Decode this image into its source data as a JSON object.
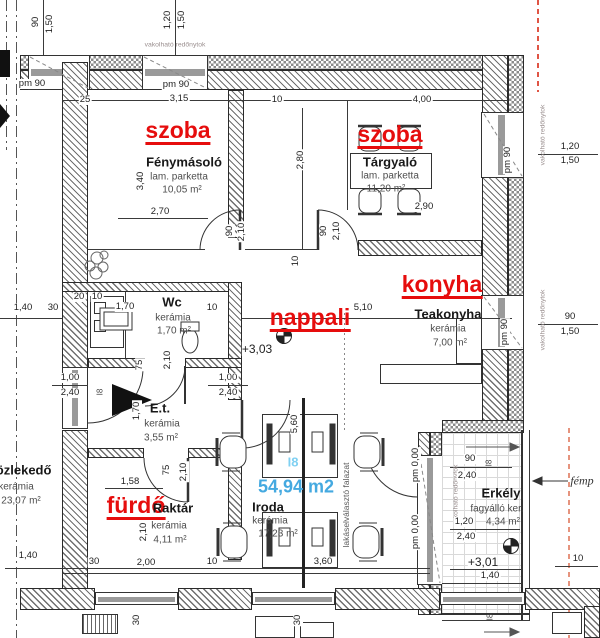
{
  "canvas": {
    "width": 600,
    "height": 638,
    "background": "#ffffff"
  },
  "colors": {
    "red_label": "#e60d0d",
    "blue_label_big": "#44a9e0",
    "blue_label_small": "#7fd0f2",
    "wall_line": "#2a2a2a",
    "dim_text": "#222222",
    "red_dash_line": "#e05545",
    "orange_dash_line": "#e6947e"
  },
  "rooms": [
    {
      "overlay": "szoba",
      "name": "Fénymásoló",
      "flooring": "lam. parketta",
      "area": "10,05 m²"
    },
    {
      "overlay": "szoba",
      "name": "Tárgyaló",
      "flooring": "lam. parketta",
      "area": "11,20 m²"
    },
    {
      "overlay": "konyha",
      "name": "Teakonyha",
      "flooring": "kerámia",
      "area": "7,00 m²"
    },
    {
      "overlay": "nappali",
      "name": "Iroda",
      "flooring": "kerámia",
      "area": "17,23 m²"
    },
    {
      "overlay": "",
      "name": "Wc",
      "flooring": "kerámia",
      "area": "1,70 m²"
    },
    {
      "overlay": "",
      "name": "E.t.",
      "flooring": "kerámia",
      "area": "3,55 m²"
    },
    {
      "overlay": "",
      "name": "közlekedő",
      "flooring": "kerámia",
      "area": "23,07 m²"
    },
    {
      "overlay": "fürdő",
      "name": "Raktár",
      "flooring": "kerámia",
      "area": "4,11 m²"
    },
    {
      "overlay": "",
      "name": "Erkély",
      "flooring": "fagyálló ker.",
      "area": "4,34 m²"
    }
  ],
  "unit": {
    "id": "I8",
    "total_area": "54,94 m2",
    "levels": [
      "+3,03",
      "+3,01"
    ]
  },
  "labels": [
    {
      "n": "dim-90-tl",
      "t": "90",
      "x": 36,
      "y": 22,
      "r": -90,
      "c": "dim"
    },
    {
      "n": "dim-150-tl",
      "t": "1,50",
      "x": 50,
      "y": 24,
      "r": -90,
      "c": "dim"
    },
    {
      "n": "dim-120-tl2",
      "t": "1,20",
      "x": 168,
      "y": 20,
      "r": -90,
      "c": "dim"
    },
    {
      "n": "dim-150-tl2",
      "t": "1,50",
      "x": 182,
      "y": 20,
      "r": -90,
      "c": "dim"
    },
    {
      "n": "redony-top",
      "t": "vakolható redőnytok",
      "x": 175,
      "y": 45,
      "r": 0,
      "c": "tiny"
    },
    {
      "n": "pm90-top-a",
      "t": "pm 90",
      "x": 32,
      "y": 84,
      "r": 0,
      "c": "dim"
    },
    {
      "n": "pm90-top-b",
      "t": "pm 90",
      "x": 176,
      "y": 85,
      "r": 0,
      "c": "dim"
    },
    {
      "n": "dim-25",
      "t": "25",
      "x": 85,
      "y": 100,
      "r": 0,
      "c": "dim"
    },
    {
      "n": "dim-315",
      "t": "3,15",
      "x": 179,
      "y": 99,
      "r": 0,
      "c": "dim"
    },
    {
      "n": "dim-10-top",
      "t": "10",
      "x": 277,
      "y": 100,
      "r": 0,
      "c": "dim"
    },
    {
      "n": "dim-400",
      "t": "4,00",
      "x": 422,
      "y": 100,
      "r": 0,
      "c": "dim"
    },
    {
      "n": "red-szoba-1",
      "t": "szoba",
      "x": 178,
      "y": 132,
      "r": 0,
      "c": "red"
    },
    {
      "n": "title-fenymasolo",
      "t": "Fénymásoló",
      "x": 184,
      "y": 162,
      "r": 0,
      "c": "rt"
    },
    {
      "n": "sub-lam-1",
      "t": "lam. parketta",
      "x": 179,
      "y": 177,
      "r": 0,
      "c": "sub"
    },
    {
      "n": "sub-area-1",
      "t": "10,05 m²",
      "x": 182,
      "y": 190,
      "r": 0,
      "c": "sub"
    },
    {
      "n": "dim-340",
      "t": "3,40",
      "x": 141,
      "y": 181,
      "r": -90,
      "c": "dim"
    },
    {
      "n": "dim-270",
      "t": "2,70",
      "x": 160,
      "y": 212,
      "r": 0,
      "c": "dim"
    },
    {
      "n": "red-szoba-2",
      "t": "szoba",
      "x": 390,
      "y": 136,
      "r": 0,
      "c": "red"
    },
    {
      "n": "title-targyalo",
      "t": "Tárgyaló",
      "x": 390,
      "y": 162,
      "r": 0,
      "c": "rt"
    },
    {
      "n": "sub-lam-2",
      "t": "lam. parketta",
      "x": 390,
      "y": 176,
      "r": 0,
      "c": "sub"
    },
    {
      "n": "sub-area-2",
      "t": "11,20 m²",
      "x": 386,
      "y": 189,
      "r": 0,
      "c": "sub"
    },
    {
      "n": "dim-290",
      "t": "2,90",
      "x": 424,
      "y": 207,
      "r": 0,
      "c": "dim"
    },
    {
      "n": "dim-280",
      "t": "2,80",
      "x": 301,
      "y": 160,
      "r": -90,
      "c": "dim"
    },
    {
      "n": "pm90-right-top",
      "t": "pm 90",
      "x": 508,
      "y": 160,
      "r": -90,
      "c": "dim"
    },
    {
      "n": "dim-120-rt",
      "t": "1,20",
      "x": 570,
      "y": 147,
      "r": 0,
      "c": "dim"
    },
    {
      "n": "dim-150-rt",
      "t": "1,50",
      "x": 570,
      "y": 161,
      "r": 0,
      "c": "dim"
    },
    {
      "n": "redony-right-top",
      "t": "vakolható redőnytok",
      "x": 543,
      "y": 135,
      "r": -90,
      "c": "tiny"
    },
    {
      "n": "dim-90-door-l",
      "t": "90",
      "x": 230,
      "y": 231,
      "r": -90,
      "c": "dim"
    },
    {
      "n": "dim-210-door-l",
      "t": "2,10",
      "x": 242,
      "y": 232,
      "r": -90,
      "c": "dim"
    },
    {
      "n": "dim-90-door-r",
      "t": "90",
      "x": 324,
      "y": 231,
      "r": -90,
      "c": "dim"
    },
    {
      "n": "dim-210-door-r",
      "t": "2,10",
      "x": 337,
      "y": 231,
      "r": -90,
      "c": "dim"
    },
    {
      "n": "dim-10-mid",
      "t": "10",
      "x": 296,
      "y": 261,
      "r": -90,
      "c": "dim"
    },
    {
      "n": "red-konyha",
      "t": "konyha",
      "x": 442,
      "y": 286,
      "r": 0,
      "c": "red"
    },
    {
      "n": "title-teakonyha",
      "t": "Teakonyha",
      "x": 448,
      "y": 314,
      "r": 0,
      "c": "rt"
    },
    {
      "n": "sub-ker-teak",
      "t": "kerámia",
      "x": 448,
      "y": 329,
      "r": 0,
      "c": "sub"
    },
    {
      "n": "sub-area-teak",
      "t": "7,00 m²",
      "x": 450,
      "y": 343,
      "r": 0,
      "c": "sub"
    },
    {
      "n": "dim-510",
      "t": "5,10",
      "x": 363,
      "y": 308,
      "r": 0,
      "c": "dim"
    },
    {
      "n": "pm90-right-mid",
      "t": "pm 90",
      "x": 505,
      "y": 332,
      "r": -90,
      "c": "dim"
    },
    {
      "n": "dim-90-r",
      "t": "90",
      "x": 570,
      "y": 317,
      "r": 0,
      "c": "dim"
    },
    {
      "n": "dim-150-r",
      "t": "1,50",
      "x": 570,
      "y": 332,
      "r": 0,
      "c": "dim"
    },
    {
      "n": "redony-right-mid",
      "t": "vakolható redőnytok",
      "x": 543,
      "y": 320,
      "r": -90,
      "c": "tiny"
    },
    {
      "n": "red-nappali",
      "t": "nappali",
      "x": 310,
      "y": 319,
      "r": 0,
      "c": "red"
    },
    {
      "n": "lvl-303",
      "t": "+3,03",
      "x": 257,
      "y": 349,
      "r": 0,
      "c": "lvl"
    },
    {
      "n": "dim-20",
      "t": "20",
      "x": 79,
      "y": 297,
      "r": 0,
      "c": "dim"
    },
    {
      "n": "dim-10-wc-l",
      "t": "10",
      "x": 97,
      "y": 297,
      "r": 0,
      "c": "dim"
    },
    {
      "n": "title-wc",
      "t": "Wc",
      "x": 172,
      "y": 302,
      "r": 0,
      "c": "rt"
    },
    {
      "n": "sub-ker-wc",
      "t": "kerámia",
      "x": 173,
      "y": 318,
      "r": 0,
      "c": "sub"
    },
    {
      "n": "sub-area-wc",
      "t": "1,70 m²",
      "x": 174,
      "y": 331,
      "r": 0,
      "c": "sub"
    },
    {
      "n": "dim-170",
      "t": "1,70",
      "x": 125,
      "y": 307,
      "r": 0,
      "c": "dim"
    },
    {
      "n": "dim-10-wc-r",
      "t": "10",
      "x": 212,
      "y": 308,
      "r": 0,
      "c": "dim"
    },
    {
      "n": "dim-140-l",
      "t": "1,40",
      "x": 23,
      "y": 308,
      "r": 0,
      "c": "dim"
    },
    {
      "n": "dim-30-l",
      "t": "30",
      "x": 53,
      "y": 308,
      "r": 0,
      "c": "dim"
    },
    {
      "n": "dim-75-wc",
      "t": "75",
      "x": 140,
      "y": 365,
      "r": -90,
      "c": "dim"
    },
    {
      "n": "dim-210-wc",
      "t": "2,10",
      "x": 168,
      "y": 360,
      "r": -90,
      "c": "dim"
    },
    {
      "n": "dim-100-pl",
      "t": "1,00",
      "x": 70,
      "y": 378,
      "r": 0,
      "c": "dim"
    },
    {
      "n": "dim-240-pl",
      "t": "2,40",
      "x": 70,
      "y": 393,
      "r": 0,
      "c": "dim"
    },
    {
      "n": "dim-100-pr",
      "t": "1,00",
      "x": 228,
      "y": 378,
      "r": 0,
      "c": "dim"
    },
    {
      "n": "dim-240-pr",
      "t": "2,40",
      "x": 228,
      "y": 393,
      "r": 0,
      "c": "dim"
    },
    {
      "n": "dim-170-v",
      "t": "1,70",
      "x": 137,
      "y": 411,
      "r": -90,
      "c": "dim"
    },
    {
      "n": "title-et",
      "t": "E.t.",
      "x": 160,
      "y": 408,
      "r": 0,
      "c": "rt"
    },
    {
      "n": "sub-ker-et",
      "t": "kerámia",
      "x": 162,
      "y": 424,
      "r": 0,
      "c": "sub"
    },
    {
      "n": "sub-area-et",
      "t": "3,55 m²",
      "x": 161,
      "y": 438,
      "r": 0,
      "c": "sub"
    },
    {
      "n": "title-kozlekedo",
      "t": "közlekedő",
      "x": 20,
      "y": 470,
      "r": 0,
      "c": "rt"
    },
    {
      "n": "sub-ker-koz",
      "t": "kerámia",
      "x": 16,
      "y": 487,
      "r": 0,
      "c": "sub"
    },
    {
      "n": "sub-area-koz",
      "t": "23,07 m²",
      "x": 21,
      "y": 501,
      "r": 0,
      "c": "sub"
    },
    {
      "n": "dim-158",
      "t": "1,58",
      "x": 130,
      "y": 482,
      "r": 0,
      "c": "dim"
    },
    {
      "n": "dim-75-f",
      "t": "75",
      "x": 167,
      "y": 470,
      "r": -90,
      "c": "dim"
    },
    {
      "n": "dim-210-f",
      "t": "2,10",
      "x": 184,
      "y": 472,
      "r": -90,
      "c": "dim"
    },
    {
      "n": "red-furdo",
      "t": "fürdő",
      "x": 136,
      "y": 507,
      "r": 0,
      "c": "red"
    },
    {
      "n": "title-raktar",
      "t": "Raktár",
      "x": 173,
      "y": 508,
      "r": 0,
      "c": "rt"
    },
    {
      "n": "sub-ker-rak",
      "t": "kerámia",
      "x": 169,
      "y": 526,
      "r": 0,
      "c": "sub"
    },
    {
      "n": "sub-area-rak",
      "t": "4,11 m²",
      "x": 170,
      "y": 540,
      "r": 0,
      "c": "sub"
    },
    {
      "n": "dim-210-rak",
      "t": "2,10",
      "x": 144,
      "y": 532,
      "r": -90,
      "c": "dim"
    },
    {
      "n": "dim-140-bl",
      "t": "1,40",
      "x": 28,
      "y": 556,
      "r": 0,
      "c": "dim"
    },
    {
      "n": "dim-30-b",
      "t": "30",
      "x": 94,
      "y": 562,
      "r": 0,
      "c": "dim"
    },
    {
      "n": "dim-200-b",
      "t": "2,00",
      "x": 146,
      "y": 563,
      "r": 0,
      "c": "dim"
    },
    {
      "n": "dim-10-b",
      "t": "10",
      "x": 212,
      "y": 562,
      "r": 0,
      "c": "dim"
    },
    {
      "n": "dim-360-b",
      "t": "3,60",
      "x": 323,
      "y": 562,
      "r": 0,
      "c": "dim"
    },
    {
      "n": "dim-10-br",
      "t": "10",
      "x": 578,
      "y": 559,
      "r": 0,
      "c": "dim"
    },
    {
      "n": "dim-560",
      "t": "5,60",
      "x": 295,
      "y": 424,
      "r": -90,
      "c": "dim"
    },
    {
      "n": "blue-unit-id",
      "t": "I8",
      "x": 293,
      "y": 462,
      "r": 0,
      "c": "blue1"
    },
    {
      "n": "blue-total-area",
      "t": "54,94 m2",
      "x": 296,
      "y": 487,
      "r": 0,
      "c": "blue2"
    },
    {
      "n": "title-iroda",
      "t": "Iroda",
      "x": 268,
      "y": 507,
      "r": 0,
      "c": "rt"
    },
    {
      "n": "sub-ker-ir",
      "t": "kerámia",
      "x": 270,
      "y": 521,
      "r": 0,
      "c": "sub"
    },
    {
      "n": "sub-area-ir",
      "t": "17,23 m²",
      "x": 278,
      "y": 534,
      "r": 0,
      "c": "sub"
    },
    {
      "n": "wall-note",
      "t": "lakáselválasztó falazat",
      "x": 346,
      "y": 505,
      "r": -90,
      "c": "note"
    },
    {
      "n": "pm000-a",
      "t": "pm 0,00",
      "x": 416,
      "y": 465,
      "r": -90,
      "c": "dim"
    },
    {
      "n": "pm000-b",
      "t": "pm 0,00",
      "x": 416,
      "y": 532,
      "r": -90,
      "c": "dim"
    },
    {
      "n": "redony-balcony",
      "t": "vakolható redőnytok",
      "x": 456,
      "y": 495,
      "r": -90,
      "c": "tiny"
    },
    {
      "n": "title-erkely",
      "t": "Erkély",
      "x": 501,
      "y": 493,
      "r": 0,
      "c": "rt"
    },
    {
      "n": "sub-fagyallo",
      "t": "fagyálló ker.",
      "x": 497,
      "y": 509,
      "r": 0,
      "c": "sub"
    },
    {
      "n": "dim-120-e",
      "t": "1,20",
      "x": 464,
      "y": 522,
      "r": 0,
      "c": "dim"
    },
    {
      "n": "sub-area-erk",
      "t": "4,34 m²",
      "x": 503,
      "y": 522,
      "r": 0,
      "c": "sub"
    },
    {
      "n": "dim-240-e1",
      "t": "2,40",
      "x": 466,
      "y": 537,
      "r": 0,
      "c": "dim"
    },
    {
      "n": "dim-90-e",
      "t": "90",
      "x": 470,
      "y": 459,
      "r": 0,
      "c": "dim"
    },
    {
      "n": "dim-240-e0",
      "t": "2,40",
      "x": 467,
      "y": 476,
      "r": 0,
      "c": "dim"
    },
    {
      "n": "lvl-301",
      "t": "+3,01",
      "x": 483,
      "y": 562,
      "r": 0,
      "c": "lvl"
    },
    {
      "n": "dim-140-e",
      "t": "1,40",
      "x": 490,
      "y": 576,
      "r": 0,
      "c": "dim"
    },
    {
      "n": "femp-note",
      "t": "fémp",
      "x": 582,
      "y": 481,
      "r": 0,
      "c": "femp"
    },
    {
      "n": "i8-entry",
      "t": "I8",
      "x": 100,
      "y": 392,
      "r": -90,
      "c": "tiny2"
    },
    {
      "n": "i8-erkely-top",
      "t": "I8",
      "x": 489,
      "y": 463,
      "r": -90,
      "c": "tiny2"
    },
    {
      "n": "i8-erkely-bot",
      "t": "I8",
      "x": 490,
      "y": 617,
      "r": -90,
      "c": "tiny2"
    },
    {
      "n": "dim-30-v1",
      "t": "30",
      "x": 137,
      "y": 620,
      "r": -90,
      "c": "dim"
    },
    {
      "n": "dim-30-v2",
      "t": "30",
      "x": 298,
      "y": 620,
      "r": -90,
      "c": "dim"
    }
  ]
}
